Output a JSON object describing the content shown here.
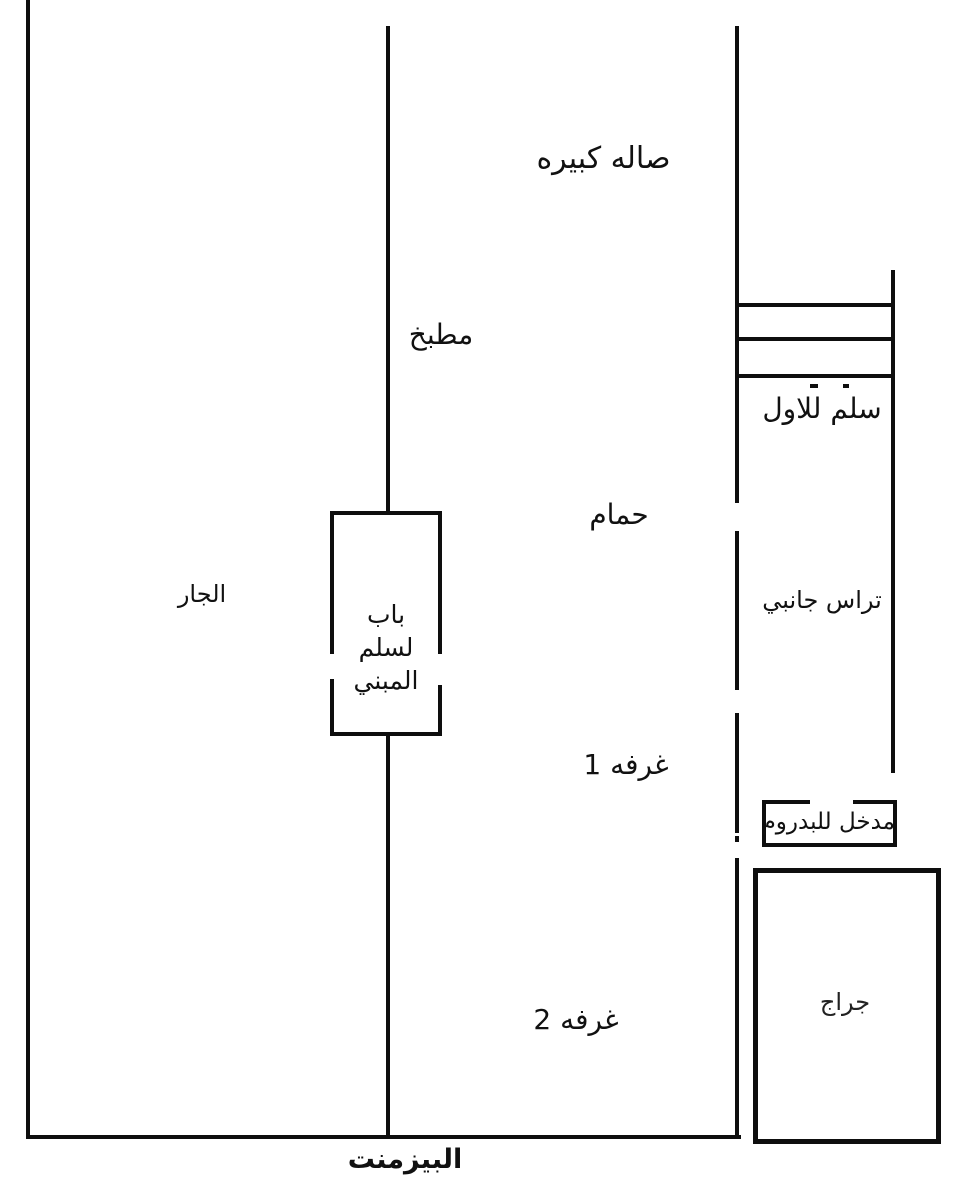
{
  "page": {
    "description_label": "Hand-drawn basement floor plan sketch"
  },
  "colors": {
    "line": "#0e0e0e",
    "text": "#111111",
    "background": "#ffffff"
  },
  "labels": {
    "hall": "صاله كبيره",
    "kitchen": "مطبخ",
    "stairs_to_first": "سلم للاول",
    "bathroom": "حمام",
    "neighbor": "الجار",
    "side_terrace": "تراس جانبي",
    "stair_door_line1": "باب",
    "stair_door_line2": "لسلم",
    "stair_door_line3": "المبني",
    "room1": "غرفه 1",
    "basement_entrance": "مدخل للبدروم",
    "room2": "غرفه 2",
    "garage": "جراج",
    "basement": "البيزمنت"
  }
}
